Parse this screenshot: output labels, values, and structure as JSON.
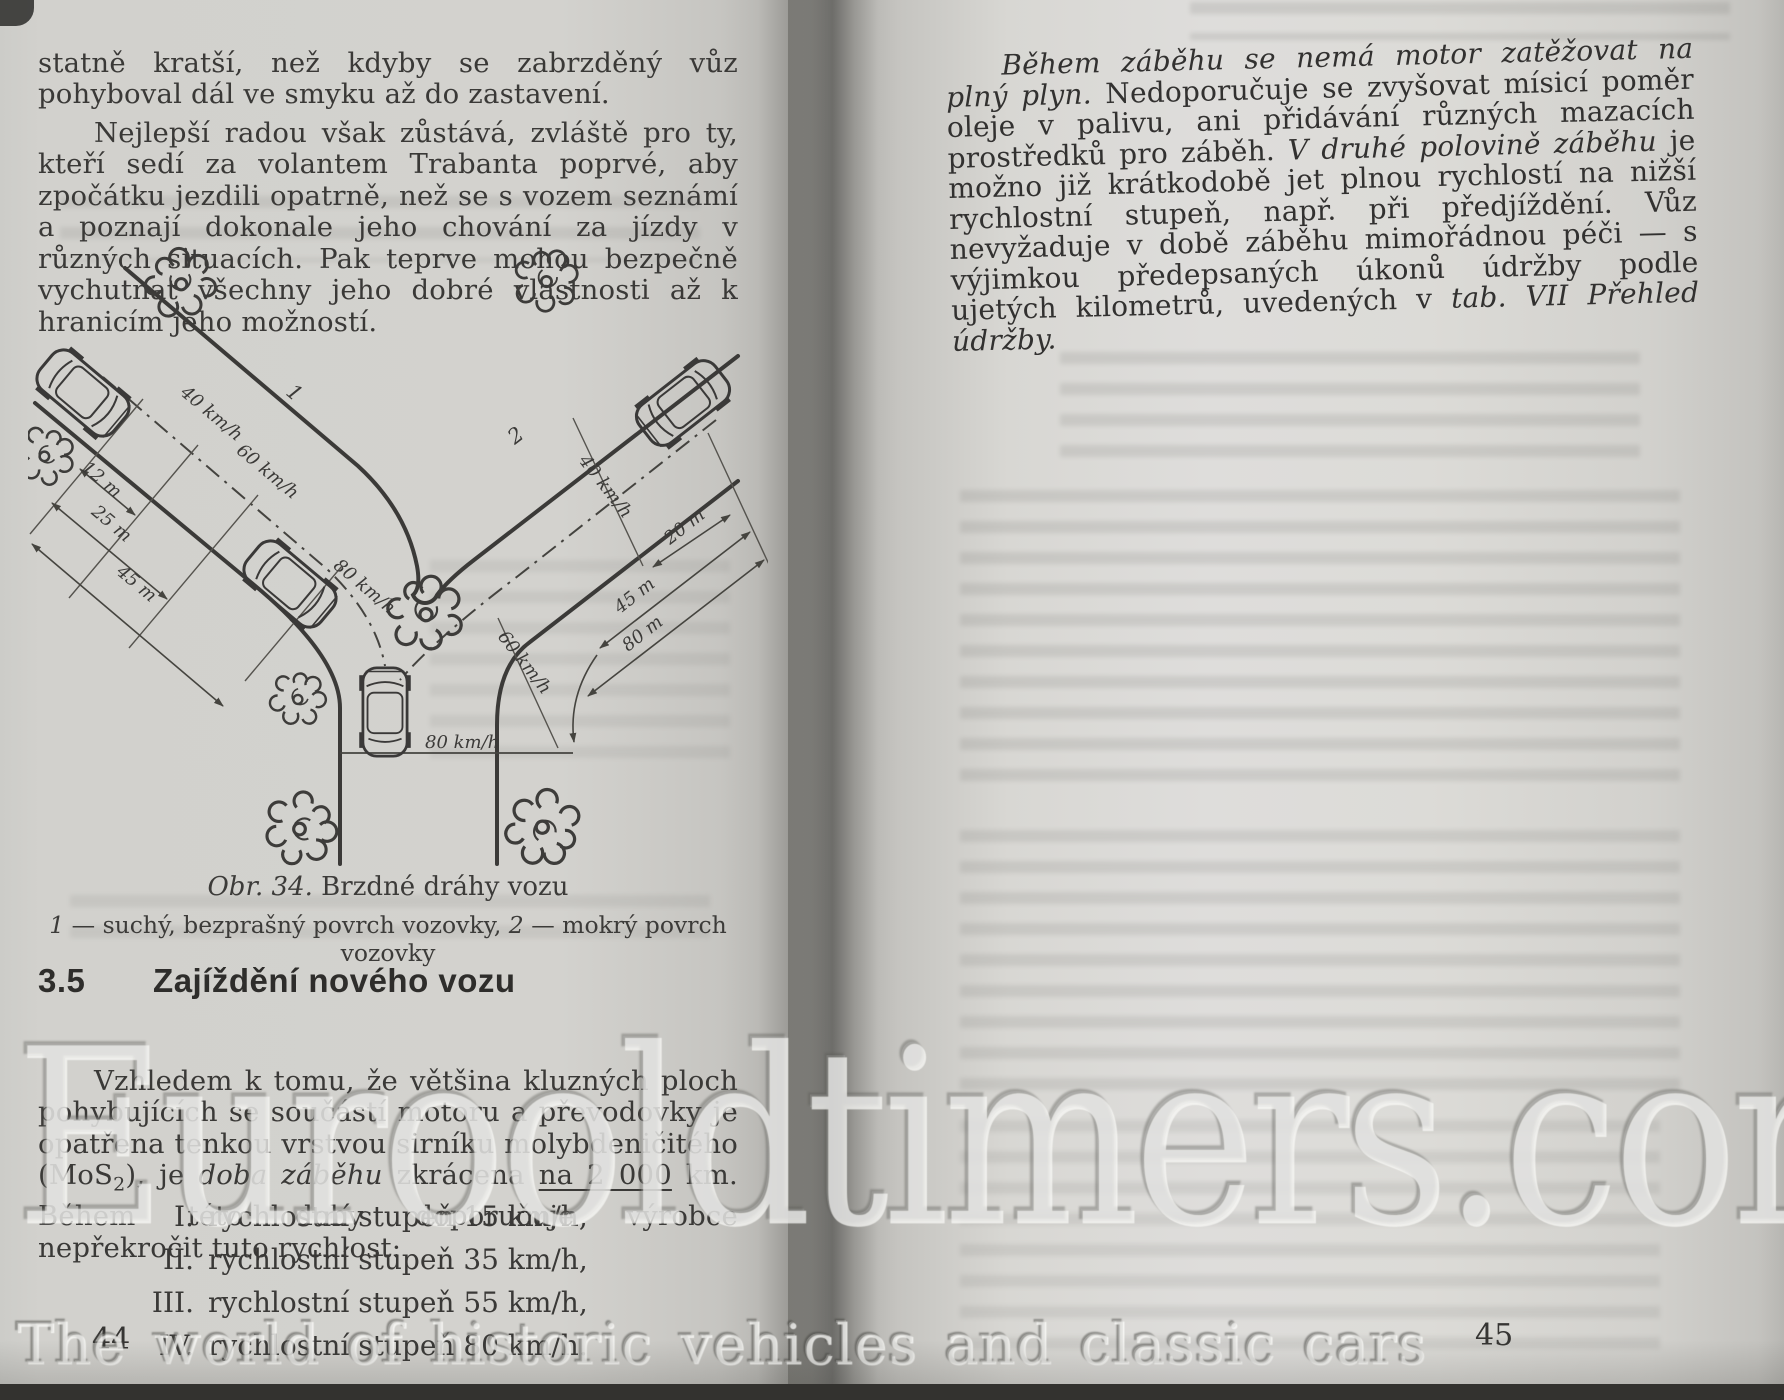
{
  "watermark": {
    "main": "Eurooldtimers.com",
    "tagline": "The world of historic vehicles and classic cars"
  },
  "left_page": {
    "page_number": "44",
    "para1": "statně kratší, než kdyby se zabrzděný vůz pohyboval dál ve smyku až do zastavení.",
    "para2": "Nejlepší radou však zůstává, zvláště pro ty, kteří sedí za volantem Trabanta poprvé, aby zpočátku jezdili opatrně, než se s vozem seznámí a poznají dokonale jeho chování za jízdy v různých situacích. Pak teprve mohou bezpečně vychutnat všechny jeho dobré vlastnosti až k hranicím jeho možností.",
    "figure": {
      "caption_no": "Obr. 34.",
      "caption_title": " Brzdné dráhy vozu",
      "legend_k1": "1",
      "legend_v1": " — suchý, bezprašný povrch vozovky, ",
      "legend_k2": "2",
      "legend_v2": " — mokrý povrch vozovky",
      "road1_label": "1",
      "road2_label": "2",
      "left_speeds": [
        "40 km/h",
        "60 km/h",
        "80 km/h"
      ],
      "left_distances": [
        "12 m",
        "25 m",
        "45 m"
      ],
      "right_speeds": [
        "40 km/h",
        "60 km/h"
      ],
      "right_distances": [
        "20 m",
        "45 m",
        "80 m"
      ],
      "bottom_speed": "80 km/h"
    },
    "section": {
      "number": "3.5",
      "title": "Zajíždění nového vozu"
    },
    "para3": {
      "t1": "Vzhledem k tomu, že většina kluzných ploch pohybujících se součástí motoru a převodovky je opatřena tenkou vrstvou sirníku molybdeničitého (MoS",
      "sub": "2",
      "t2": "), je ",
      "i1": "doba záběhu",
      "t3": " zkrácena ",
      "u1": "na 2 000",
      "t4": " km. Během této doby doporučuje výrobce nepřekročit tuto rychlost:"
    },
    "list": [
      {
        "numeral": "I.",
        "text": "rychlostní stupeň 15 km/h,"
      },
      {
        "numeral": "II.",
        "text": "rychlostní stupeň 35 km/h,"
      },
      {
        "numeral": "III.",
        "text": "rychlostní stupeň 55 km/h,"
      },
      {
        "numeral": "IV.",
        "text": "rychlostní stupeň 80 km/h."
      }
    ]
  },
  "right_page": {
    "page_number": "45",
    "para1": {
      "i1": "Během záběhu se nemá motor zatěžovat na plný plyn.",
      "t1": " Nedoporučuje se zvyšovat mísicí poměr oleje v palivu, ani přidávání různých mazacích prostředků pro záběh. ",
      "i2": "V druhé polovině záběhu",
      "t2": " je možno již krátkodobě jet plnou rychlostí na nižší rychlostní stupeň, např. při předjíždění. Vůz nevyžaduje v době záběhu mimořádnou péči — s výjimkou předepsaných úkonů údržby podle ujetých kilometrů, uvedených v ",
      "i3": "tab. VII Přehled údržby."
    }
  }
}
